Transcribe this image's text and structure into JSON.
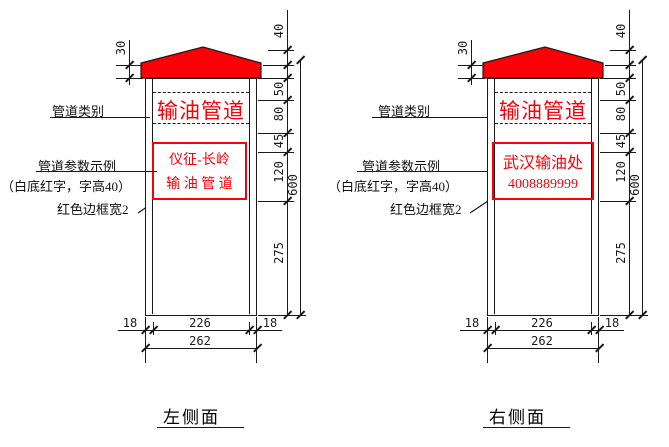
{
  "colors": {
    "accent_red": "#fb0006",
    "line_black": "#1a1a1a",
    "background": "#ffffff"
  },
  "dimensions": {
    "cap_band_height": "30",
    "cap_peak_height": "40",
    "seg_top": "50",
    "seg_category": "80",
    "seg_gap": "45",
    "seg_panel": "120",
    "seg_bottom": "275",
    "total_height": "600",
    "wall_left": "18",
    "inner_width": "226",
    "wall_right": "18",
    "total_width": "262"
  },
  "annotations": {
    "category_label": "管道类别",
    "param_label": "管道参数示例",
    "param_note": "（白底红字，字高40）",
    "border_note": "红色边框宽2"
  },
  "left_view": {
    "title": "左侧面",
    "category_text": "输油管道",
    "panel_line1": "仪征-长岭",
    "panel_line2": "输 油 管 道"
  },
  "right_view": {
    "title": "右侧面",
    "category_text": "输油管道",
    "panel_line1": "武汉输油处",
    "panel_line2": "4008889999"
  }
}
